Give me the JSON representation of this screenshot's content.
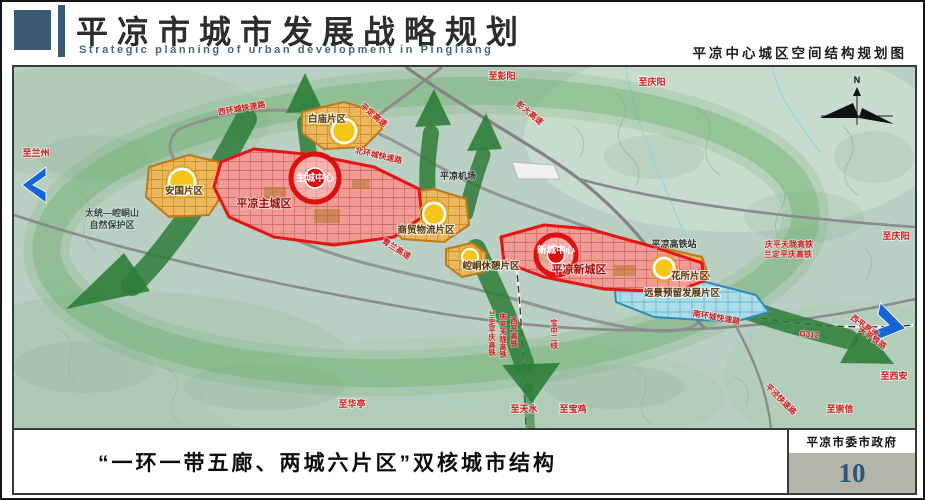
{
  "header": {
    "title_cn": "平凉市城市发展战略规划",
    "title_en": "Strategic planning of urban development in Pingliang",
    "subtitle_right": "平凉中心城区空间结构规划图",
    "accent_color": "#3b5a74"
  },
  "footer": {
    "caption": "“一环一带五廊、两城六片区”双核城市结构",
    "agency": "平凉市委市政府",
    "page_number": "10",
    "page_number_color": "#2b5878"
  },
  "map": {
    "compass": {
      "north_label": "N"
    },
    "colors": {
      "belt_blue": "#1565d8",
      "corridor_green": "#2e7d38",
      "ring_green": "#74b274",
      "core_red": "#e01515",
      "district_orange": "#eab254",
      "reserve_cyan": "#a8dbe8"
    },
    "cities": {
      "main": {
        "name": "平凉主城区",
        "center": "主城中心"
      },
      "new": {
        "name": "平凉新城区",
        "center": "新城中心"
      }
    },
    "districts": {
      "anguo": "安国片区",
      "baimiao": "白庙片区",
      "trade": "商贸物流片区",
      "leisure": "崆峒休憩片区",
      "huasuo": "花所片区",
      "reserve_dev": "远景预留发展片区"
    },
    "facilities": {
      "airport": "平凉机场",
      "hsr_station": "平凉高铁站"
    },
    "nature_reserve": {
      "line1": "太统—崆峒山",
      "line2": "自然保护区"
    },
    "roads": {
      "west_ring": "西环城快速路",
      "north_ring": "北环城快速路",
      "south_ring": "南环城快速路",
      "pingding": "平定高速",
      "pengda": "彭大高速",
      "qinglan": "青兰高速",
      "xiping_expwy": "西平高速",
      "pingjing": "平泾快速路",
      "g312": "G312"
    },
    "railways": {
      "tianping": "天平铁路",
      "baozhong2": "宝中二线",
      "xiping_hsr": "西平高铁",
      "qingpingtianlong": "庆平天陇高铁",
      "landingpingqing": "兰定平庆高铁"
    },
    "directions": {
      "lanzhou": "至兰州",
      "pengyang": "至彭阳",
      "qingyang": "至庆阳",
      "xian": "至西安",
      "chongxin": "至崇信",
      "huating": "至华亭",
      "tianshui": "至天水",
      "baoji": "至宝鸡"
    }
  }
}
